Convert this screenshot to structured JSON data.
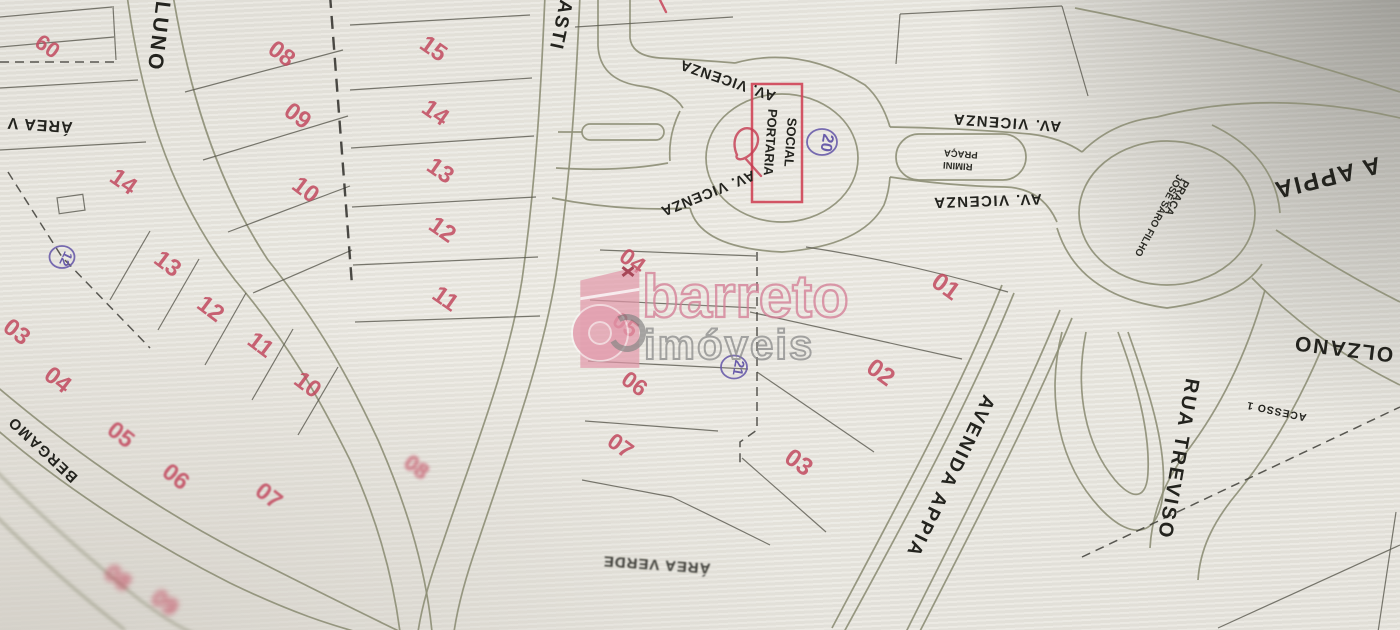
{
  "watermark": {
    "brand": "barreto",
    "segment": "imóveis"
  },
  "colors": {
    "lot_number_red": "#c24a5f",
    "pen_ink_purple": "#695caa",
    "portaria_box_red": "#cf4457",
    "road_line_olive": "#8d8e76",
    "street_text_black": "#23231e",
    "watermark_pink": "#d47e95",
    "watermark_gray": "#868686",
    "paper": "#e9e7e0"
  },
  "map": {
    "gatehouse": {
      "line1": "PORTARIA",
      "line2": "SOCIAL"
    },
    "street_labels": [
      {
        "label": "LUNO",
        "x": 152,
        "y": 36,
        "rot": 97,
        "size": 21,
        "ls": 3,
        "name": "street-label-luno"
      },
      {
        "label": "ASTI",
        "x": 555,
        "y": 24,
        "rot": 102,
        "size": 19,
        "ls": 2,
        "name": "street-label-asti"
      },
      {
        "label": "AV. VICENZA",
        "x": 729,
        "y": 76,
        "rot": 199,
        "size": 14.5,
        "ls": 1,
        "name": "street-label-av-vicenza-nw"
      },
      {
        "label": "AV. VICENZA",
        "x": 706,
        "y": 189,
        "rot": 158,
        "size": 14.5,
        "ls": 1,
        "name": "street-label-av-vicenza-sw"
      },
      {
        "label": "AV. VICENZA",
        "x": 1007,
        "y": 118,
        "rot": 184,
        "size": 15,
        "ls": 1.5,
        "name": "street-label-av-vicenza-ne"
      },
      {
        "label": "AV. VICENZA",
        "x": 987,
        "y": 196,
        "rot": 178,
        "size": 15,
        "ls": 1.5,
        "name": "street-label-av-vicenza-se"
      },
      {
        "label": "A APPIA",
        "x": 1325,
        "y": 170,
        "rot": 166,
        "size": 24,
        "ls": 2,
        "name": "street-label-via-appia"
      },
      {
        "label": "AVENIDA APPIA",
        "x": 945,
        "y": 474,
        "rot": 116,
        "size": 19,
        "ls": 2.5,
        "name": "street-label-avenida-appia"
      },
      {
        "label": "RUA TREVISO",
        "x": 1172,
        "y": 458,
        "rot": 100,
        "size": 20,
        "ls": 2.5,
        "name": "street-label-rua-treviso"
      },
      {
        "label": "OLZANO",
        "x": 1344,
        "y": 342,
        "rot": 187,
        "size": 21,
        "ls": 2,
        "name": "street-label-bolzano"
      },
      {
        "label": "ACESSO 1",
        "x": 1277,
        "y": 408,
        "rot": 192,
        "size": 10.5,
        "ls": 1,
        "name": "street-label-acesso-1"
      },
      {
        "label": "BERGAMO",
        "x": 46,
        "y": 446,
        "rot": 223,
        "size": 15,
        "ls": 1.5,
        "name": "street-label-bergamo"
      },
      {
        "label": "ÁREA V",
        "x": 40,
        "y": 120,
        "rot": 184,
        "size": 16,
        "ls": 1,
        "name": "area-verde-label-west"
      },
      {
        "label": "ÁREA VERDE",
        "x": 657,
        "y": 560,
        "rot": 184,
        "size": 15,
        "ls": 1,
        "blur": 1,
        "op": 0.85,
        "name": "area-verde-label-south"
      }
    ],
    "plaza_labels": [
      {
        "label": "PRAÇA",
        "x": 961,
        "y": 151,
        "rot": 184,
        "size": 9.5,
        "name": "praca-rimini-label"
      },
      {
        "label": "RIMINI",
        "x": 958,
        "y": 163,
        "rot": 184,
        "size": 9.5,
        "name": "praca-rimini-label"
      },
      {
        "label": "PRAÇA",
        "x": 1174,
        "y": 196,
        "rot": 118,
        "size": 11,
        "name": "praca-jose-saro-filho-label"
      },
      {
        "label": "JOSÉ SARO FILHO",
        "x": 1156,
        "y": 214,
        "rot": 118,
        "size": 10,
        "name": "praca-jose-saro-filho-label"
      }
    ],
    "lot_numbers": [
      {
        "n": "09",
        "x": 52,
        "y": 40,
        "rot": 215,
        "size": 22
      },
      {
        "n": "08",
        "x": 277,
        "y": 60,
        "rot": 37,
        "size": 24
      },
      {
        "n": "09",
        "x": 293,
        "y": 122,
        "rot": 37,
        "size": 24
      },
      {
        "n": "10",
        "x": 301,
        "y": 196,
        "rot": 37,
        "size": 24
      },
      {
        "n": "14",
        "x": 119,
        "y": 188,
        "rot": 35,
        "size": 24
      },
      {
        "n": "13",
        "x": 163,
        "y": 270,
        "rot": 37,
        "size": 24
      },
      {
        "n": "12",
        "x": 206,
        "y": 315,
        "rot": 37,
        "size": 24
      },
      {
        "n": "11",
        "x": 256,
        "y": 351,
        "rot": 37,
        "size": 24
      },
      {
        "n": "10",
        "x": 303,
        "y": 391,
        "rot": 37,
        "size": 24
      },
      {
        "n": "15",
        "x": 429,
        "y": 55,
        "rot": 35,
        "size": 24
      },
      {
        "n": "14",
        "x": 431,
        "y": 119,
        "rot": 35,
        "size": 24
      },
      {
        "n": "13",
        "x": 436,
        "y": 177,
        "rot": 35,
        "size": 24
      },
      {
        "n": "12",
        "x": 438,
        "y": 236,
        "rot": 35,
        "size": 24
      },
      {
        "n": "11",
        "x": 441,
        "y": 305,
        "rot": 35,
        "size": 24
      },
      {
        "n": "04",
        "x": 628,
        "y": 267,
        "rot": 36,
        "size": 23
      },
      {
        "n": "05",
        "x": 621,
        "y": 331,
        "rot": 36,
        "size": 23
      },
      {
        "n": "06",
        "x": 630,
        "y": 390,
        "rot": 36,
        "size": 23
      },
      {
        "n": "07",
        "x": 616,
        "y": 452,
        "rot": 36,
        "size": 23
      },
      {
        "n": "01",
        "x": 941,
        "y": 293,
        "rot": 36,
        "size": 25
      },
      {
        "n": "02",
        "x": 876,
        "y": 379,
        "rot": 36,
        "size": 25
      },
      {
        "n": "03",
        "x": 794,
        "y": 469,
        "rot": 36,
        "size": 25
      },
      {
        "n": "03",
        "x": 12,
        "y": 338,
        "rot": 38,
        "size": 24
      },
      {
        "n": "04",
        "x": 53,
        "y": 386,
        "rot": 38,
        "size": 24
      },
      {
        "n": "05",
        "x": 116,
        "y": 441,
        "rot": 38,
        "size": 24,
        "blur": 1
      },
      {
        "n": "06",
        "x": 171,
        "y": 483,
        "rot": 38,
        "size": 24,
        "blur": 1
      },
      {
        "n": "07",
        "x": 264,
        "y": 502,
        "rot": 38,
        "size": 24,
        "blur": 1
      },
      {
        "n": "08",
        "x": 412,
        "y": 473,
        "rot": 38,
        "size": 22,
        "blur": 2,
        "op": 0.6
      },
      {
        "n": "08",
        "x": 113,
        "y": 584,
        "rot": 38,
        "size": 24,
        "blur": 3,
        "op": 0.5
      },
      {
        "n": "09",
        "x": 160,
        "y": 609,
        "rot": 38,
        "size": 24,
        "blur": 3,
        "op": 0.5
      }
    ],
    "ink_annotations": [
      {
        "n": "20",
        "x": 822,
        "y": 142,
        "rot": 100,
        "size": 16
      },
      {
        "n": "21",
        "x": 734,
        "y": 367,
        "rot": 100,
        "size": 14
      },
      {
        "n": "12",
        "x": 62,
        "y": 257,
        "rot": 115,
        "size": 13
      }
    ]
  }
}
